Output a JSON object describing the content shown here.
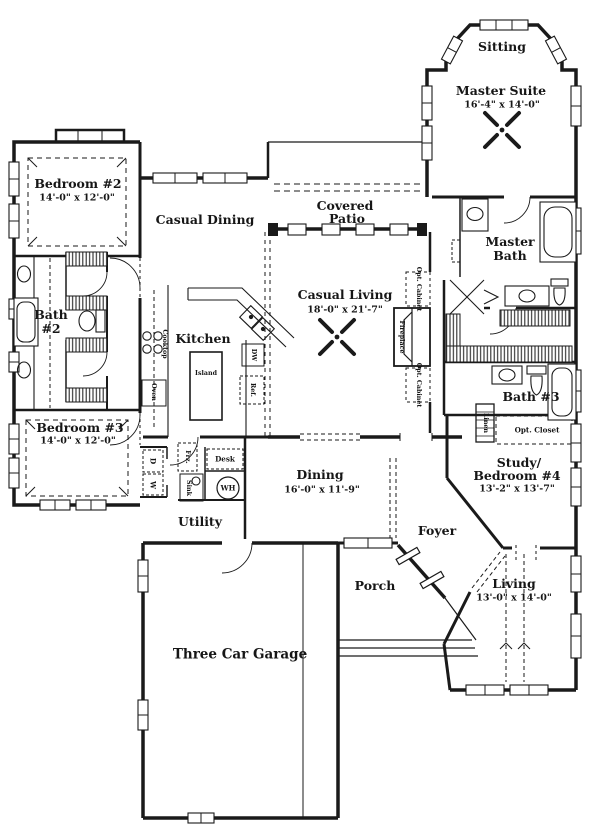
{
  "plan": {
    "title": "First floor plan",
    "rooms": {
      "sitting": {
        "name": "Sitting"
      },
      "master_suite": {
        "name": "Master Suite",
        "dims": "16'-4\" x 14'-0\""
      },
      "bedroom_2": {
        "name": "Bedroom #2",
        "dims": "14'-0\" x 12'-0\""
      },
      "casual_dining": {
        "name": "Casual Dining"
      },
      "covered_patio": {
        "line1": "Covered",
        "line2": "Patio"
      },
      "master_bath": {
        "line1": "Master",
        "line2": "Bath"
      },
      "bath_2": {
        "line1": "Bath",
        "line2": "#2"
      },
      "kitchen": {
        "name": "Kitchen"
      },
      "casual_living": {
        "name": "Casual Living",
        "dims": "18'-0\" x 21'-7\""
      },
      "bedroom_3": {
        "name": "Bedroom #3",
        "dims": "14'-0\" x 12'-0\""
      },
      "bath_3": {
        "name": "Bath #3"
      },
      "dining": {
        "name": "Dining",
        "dims": "16'-0\" x 11'-9\""
      },
      "study_bedroom_4": {
        "line1": "Study/",
        "line2": "Bedroom #4",
        "dims": "13'-2\" x 13'-7\""
      },
      "utility": {
        "name": "Utility"
      },
      "foyer": {
        "name": "Foyer"
      },
      "porch": {
        "name": "Porch"
      },
      "living": {
        "name": "Living",
        "dims": "13'-0\" x 14'-0\""
      },
      "garage": {
        "name": "Three Car Garage"
      }
    },
    "fixtures": {
      "island": "Island",
      "cooktop": "Cooktop",
      "oven": "Oven",
      "dishwasher": "DW",
      "refrigerator": "Ref.",
      "desk": "Desk",
      "washer": "W",
      "dryer": "D",
      "water_heater": "WH",
      "freezer": "Frz.",
      "sink": "Sink",
      "fireplace": "Fireplace",
      "opt_cabinet": "Opt. Cabinet",
      "opt_closet": "Opt. Closet",
      "linen": "Linen"
    },
    "colors": {
      "ink": "#1a1a1a",
      "paper": "#ffffff"
    }
  }
}
